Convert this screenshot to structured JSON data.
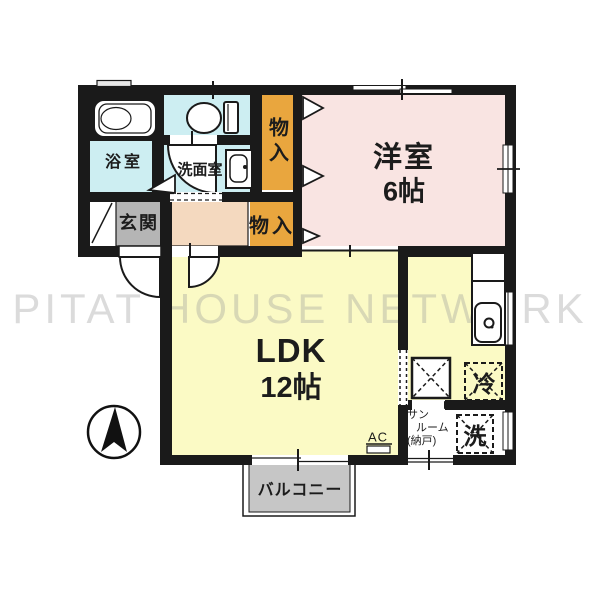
{
  "watermark": "PITAT HOUSE NETWORK",
  "labels": {
    "bath": "浴室",
    "washroom": "洗面室",
    "closet_upper": "物入",
    "closet_lower": "物入",
    "entrance": "玄関",
    "western_room": "洋室",
    "western_size": "6帖",
    "ldk": "LDK",
    "ldk_size": "12帖",
    "sunroom_line1": "サン",
    "sunroom_line2": "ルーム",
    "sunroom_line3": "(納戸)",
    "washer": "洗",
    "fridge": "冷",
    "balcony": "バルコニー",
    "ac": "AC"
  },
  "icons": {
    "compass": "north-arrow-compass",
    "bathtub": "bathtub",
    "toilet": "toilet",
    "washbasin": "washbasin",
    "kitchen_sink": "kitchen-counter-with-sink",
    "washer_space": "dashed-washing-machine-space",
    "fridge_space": "dashed-refrigerator-space"
  },
  "colors": {
    "wall": "#1a1a1a",
    "water_blue": "#cdeef2",
    "closet_orange": "#e9a63e",
    "bedroom_pink": "#f9e4e2",
    "ldk_yellow": "#fbfac5",
    "entrance_gray": "#b5b5b5",
    "hallway_peach": "#f4d9bf",
    "balcony_gray": "#c6c6c6",
    "watermark_gray": "#c9c9c9"
  }
}
